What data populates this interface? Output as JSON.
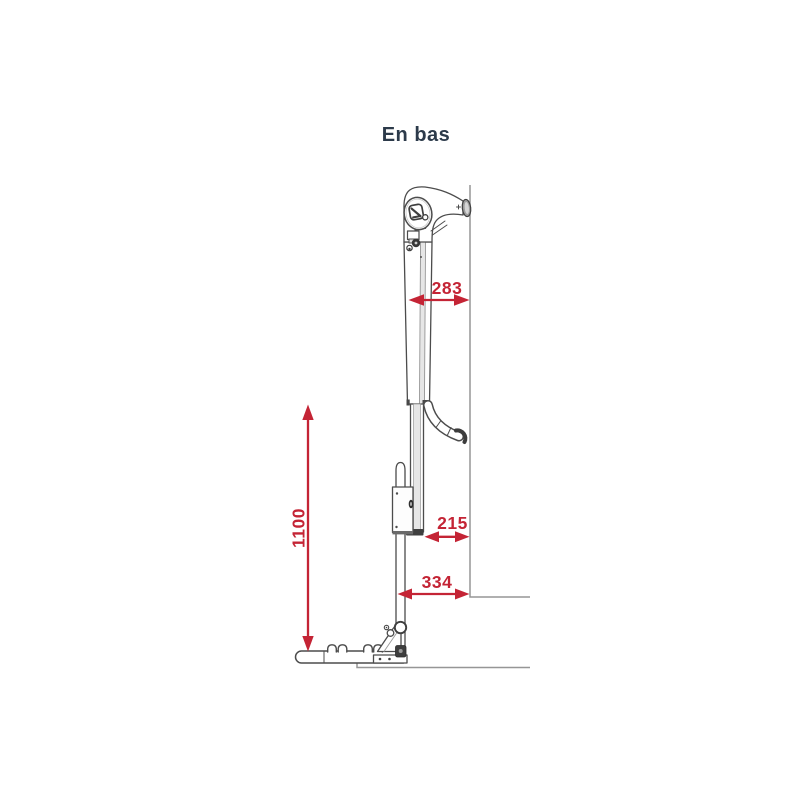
{
  "title": "En bas",
  "dimensions": {
    "top": {
      "value": "283"
    },
    "middle": {
      "value": "215"
    },
    "bottom": {
      "value": "334"
    },
    "height": {
      "value": "1100"
    }
  },
  "colors": {
    "dimension_red": "#c42435",
    "outline_gray": "#4c4c4c",
    "reference_gray": "#969696",
    "title_text": "#2c3a4a"
  }
}
